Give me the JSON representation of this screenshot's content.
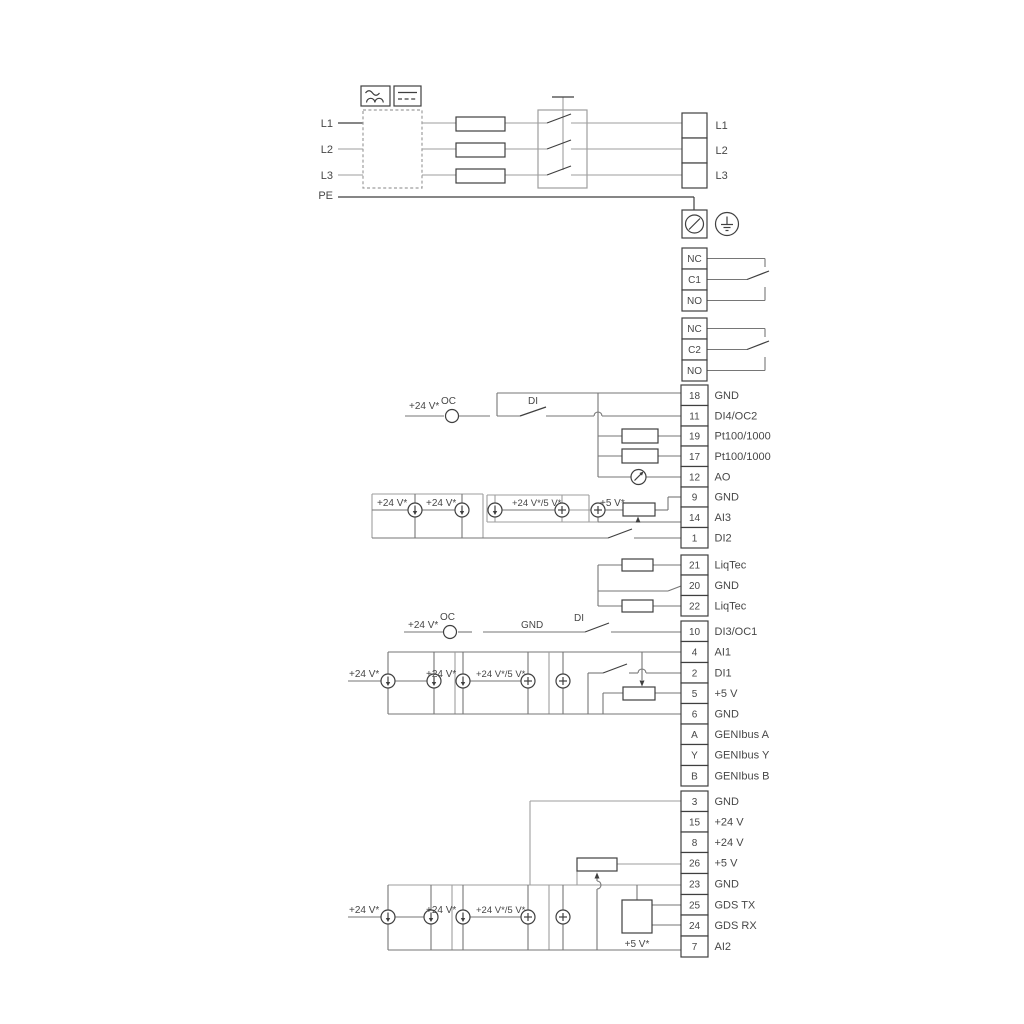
{
  "diagram_type": "pump electrical wiring diagram",
  "colors": {
    "background": "#ffffff",
    "wire_dark": "#3f3f3f",
    "wire_mid": "#767676",
    "wire_gray": "#9e9e9e",
    "text": "#474747"
  },
  "power": {
    "input_terminals": [
      "L1",
      "L2",
      "L3",
      "PE"
    ],
    "output_terminals": [
      "L1",
      "L2",
      "L3"
    ]
  },
  "icons": [
    "ac-sine-icon",
    "dc-line-icon",
    "fuse-icon",
    "disconnect-switch-icon",
    "screw-terminal-icon",
    "earth-ground-icon",
    "current-source-icon",
    "plus-source-icon",
    "meter-icon",
    "potentiometer-icon",
    "resistor-icon",
    "open-collector-icon",
    "gds-sensor-box"
  ],
  "relays": [
    {
      "name": "relay-1",
      "terminals": [
        "NC",
        "C1",
        "NO"
      ]
    },
    {
      "name": "relay-2",
      "terminals": [
        "NC",
        "C2",
        "NO"
      ]
    }
  ],
  "terminal_strips": [
    {
      "name": "io-strip-top",
      "terminals": [
        [
          "18",
          "GND"
        ],
        [
          "11",
          "DI4/OC2"
        ],
        [
          "19",
          "Pt100/1000"
        ],
        [
          "17",
          "Pt100/1000"
        ],
        [
          "12",
          "AO"
        ],
        [
          "9",
          "GND"
        ],
        [
          "14",
          "AI3"
        ],
        [
          "1",
          "DI2"
        ]
      ]
    },
    {
      "name": "liqtec-strip",
      "terminals": [
        [
          "21",
          "LiqTec"
        ],
        [
          "20",
          "GND"
        ],
        [
          "22",
          "LiqTec"
        ]
      ]
    },
    {
      "name": "io-strip-middle",
      "terminals": [
        [
          "10",
          "DI3/OC1"
        ],
        [
          "4",
          "AI1"
        ],
        [
          "2",
          "DI1"
        ],
        [
          "5",
          "+5 V"
        ],
        [
          "6",
          "GND"
        ],
        [
          "A",
          "GENIbus A"
        ],
        [
          "Y",
          "GENIbus Y"
        ],
        [
          "B",
          "GENIbus B"
        ]
      ]
    },
    {
      "name": "io-strip-bottom",
      "terminals": [
        [
          "3",
          "GND"
        ],
        [
          "15",
          "+24 V"
        ],
        [
          "8",
          "+24 V"
        ],
        [
          "26",
          "+5 V"
        ],
        [
          "23",
          "GND"
        ],
        [
          "25",
          "GDS TX"
        ],
        [
          "24",
          "GDS RX"
        ],
        [
          "7",
          "AI2"
        ]
      ]
    }
  ],
  "annotations": {
    "s1_supply": "+24 V*",
    "s1_oc": "OC",
    "s1_di": "DI",
    "s1_t1": "+24 V*",
    "s1_t2": "+24 V*",
    "s1_t3": "+24 V*/5 V*",
    "s1_5v": "+5 V*",
    "s3_supply": "+24 V*",
    "s3_oc": "OC",
    "s3_gnd": "GND",
    "s3_di": "DI",
    "s3_t1": "+24 V*",
    "s3_t2": "+24 V*",
    "s3_t3": "+24 V*/5 V*",
    "s4_t1": "+24 V*",
    "s4_t2": "+24 V*",
    "s4_t3": "+24 V*/5 V*",
    "s4_5v": "+5 V*"
  }
}
